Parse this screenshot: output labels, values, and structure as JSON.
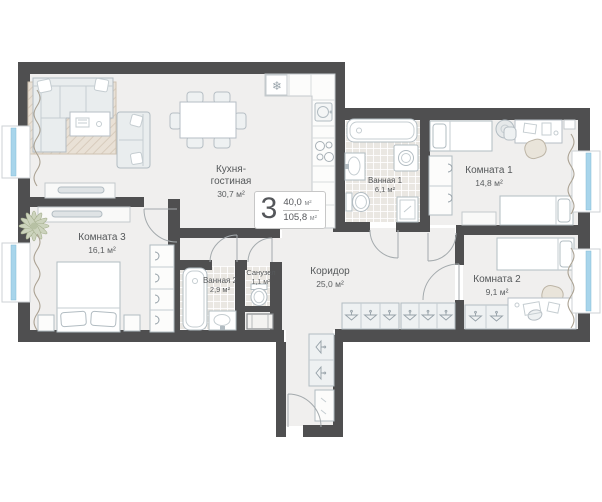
{
  "plan": {
    "badge": {
      "number": "3",
      "living_area": "40,0",
      "total_area": "105,8",
      "unit": "м²"
    },
    "rooms": [
      {
        "name": "Кухня-гостиная",
        "area": "30,7 м²"
      },
      {
        "name": "Ванная 1",
        "area": "6,1 м²"
      },
      {
        "name": "Комната 1",
        "area": "14,8 м²"
      },
      {
        "name": "Комната 2",
        "area": "9,1 м²"
      },
      {
        "name": "Комната 3",
        "area": "16,1 м²"
      },
      {
        "name": "Ванная 2",
        "area": "2,9 м²"
      },
      {
        "name": "Санузел",
        "area": "1,1 м²"
      },
      {
        "name": "Коридор",
        "area": "25,0 м²"
      }
    ],
    "icons": {
      "snowflake": "❄"
    },
    "colors": {
      "wall": "#4f4f50",
      "floor": "#f0efee",
      "window": "#a8d5eb"
    }
  }
}
